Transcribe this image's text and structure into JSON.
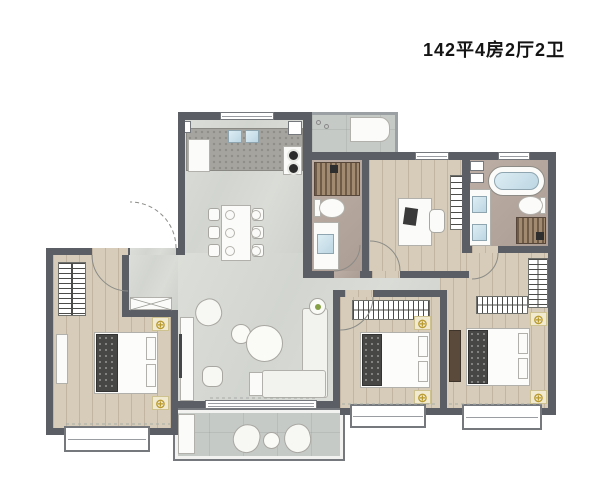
{
  "header": {
    "title": "142平4房2厅2卫"
  },
  "symbols": {
    "light_glyph": "⊕",
    "plant_color": "#86a045"
  },
  "palette": {
    "wall": "#5b5f65",
    "marble_floor": "#d6d8d3",
    "wood_floor": "#d6ccb9",
    "bath_floor": "#b5a89e",
    "balcony_floor": "#c6cac7",
    "gold_symbol": "#b89a2e",
    "water_blue": "#cfe4ee",
    "shower_slats": "#8a7660",
    "background": "#ffffff"
  }
}
